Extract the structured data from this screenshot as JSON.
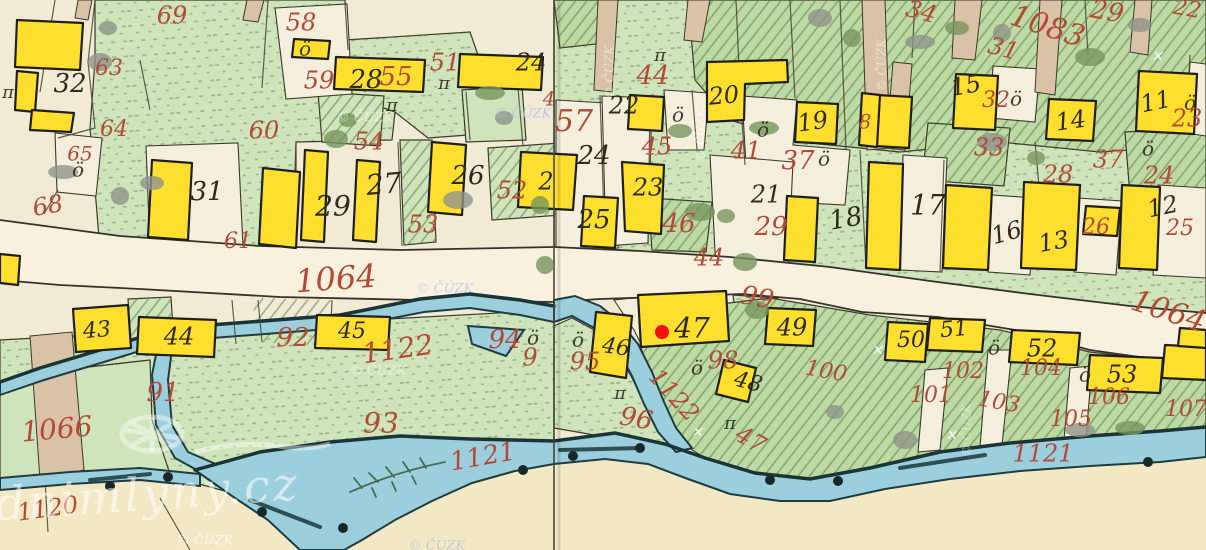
{
  "map": {
    "description": "historical hand-drawn cadastral map sheet join with stream, road and building parcels",
    "colors": {
      "paper": "#f1ebd6",
      "field_green": "#cfe4bb",
      "orchard_green": "#bdd9a4",
      "building_yellow": "#ffdf2e",
      "water_blue": "#9ccfdd",
      "road_tan": "#d9c2a6",
      "ink_black": "#2e2b1e",
      "ink_red": "#b24a36",
      "marker_red": "#f01010"
    },
    "marker": {
      "x": 662,
      "y": 332,
      "radius": 7,
      "color": "#f01010"
    },
    "labels_black": [
      [
        "32",
        70,
        85,
        26,
        0
      ],
      [
        "31",
        207,
        193,
        26,
        0
      ],
      [
        "29",
        333,
        208,
        28,
        0
      ],
      [
        "28",
        366,
        81,
        26,
        0
      ],
      [
        "27",
        384,
        186,
        28,
        -5
      ],
      [
        "26",
        468,
        177,
        26,
        0
      ],
      [
        "24",
        531,
        64,
        24,
        0
      ],
      [
        "2",
        546,
        183,
        24,
        0
      ],
      [
        "24",
        594,
        157,
        26,
        0
      ],
      [
        "25",
        594,
        221,
        26,
        0
      ],
      [
        "22",
        624,
        107,
        24,
        0
      ],
      [
        "23",
        648,
        189,
        24,
        0
      ],
      [
        "20",
        724,
        97,
        24,
        -5
      ],
      [
        "21",
        766,
        196,
        24,
        0
      ],
      [
        "19",
        813,
        123,
        24,
        -8
      ],
      [
        "18",
        846,
        220,
        26,
        -10
      ],
      [
        "17",
        928,
        207,
        28,
        0
      ],
      [
        "16",
        1007,
        234,
        24,
        -15
      ],
      [
        "15",
        966,
        87,
        24,
        -10
      ],
      [
        "14",
        1071,
        122,
        24,
        -8
      ],
      [
        "13",
        1054,
        243,
        24,
        -10
      ],
      [
        "12",
        1163,
        208,
        24,
        -12
      ],
      [
        "11",
        1156,
        103,
        24,
        -12
      ],
      [
        "43",
        97,
        331,
        22,
        -5
      ],
      [
        "44",
        179,
        338,
        24,
        0
      ],
      [
        "45",
        352,
        332,
        22,
        0
      ],
      [
        "46",
        616,
        348,
        22,
        8
      ],
      [
        "47",
        692,
        330,
        28,
        0
      ],
      [
        "48",
        748,
        383,
        22,
        15
      ],
      [
        "49",
        792,
        329,
        24,
        0
      ],
      [
        "50",
        911,
        341,
        22,
        0
      ],
      [
        "51",
        954,
        330,
        22,
        -5
      ],
      [
        "52",
        1042,
        350,
        24,
        0
      ],
      [
        "53",
        1122,
        376,
        24,
        0
      ]
    ],
    "labels_red": [
      [
        "69",
        172,
        17,
        24,
        0
      ],
      [
        "58",
        301,
        24,
        24,
        0
      ],
      [
        "59",
        319,
        82,
        24,
        0
      ],
      [
        "63",
        109,
        69,
        22,
        0
      ],
      [
        "64",
        114,
        130,
        22,
        0
      ],
      [
        "65",
        80,
        155,
        20,
        0
      ],
      [
        "68",
        48,
        207,
        24,
        -10
      ],
      [
        "60",
        264,
        132,
        24,
        0
      ],
      [
        "61",
        238,
        242,
        22,
        0
      ],
      [
        "55",
        396,
        78,
        26,
        0
      ],
      [
        "51",
        445,
        64,
        24,
        0
      ],
      [
        "54",
        369,
        143,
        24,
        0
      ],
      [
        "53",
        423,
        226,
        24,
        0
      ],
      [
        "52",
        512,
        192,
        24,
        0
      ],
      [
        "4",
        549,
        100,
        20,
        0
      ],
      [
        "57",
        574,
        123,
        30,
        0
      ],
      [
        "44",
        653,
        77,
        26,
        0
      ],
      [
        "45",
        657,
        148,
        24,
        0
      ],
      [
        "41",
        746,
        152,
        24,
        0
      ],
      [
        "37",
        798,
        162,
        26,
        0
      ],
      [
        "46",
        679,
        225,
        26,
        0
      ],
      [
        "29",
        771,
        228,
        26,
        0
      ],
      [
        "44",
        709,
        259,
        24,
        0
      ],
      [
        "34",
        921,
        13,
        24,
        15
      ],
      [
        "1083",
        1047,
        28,
        30,
        18
      ],
      [
        "29",
        1107,
        13,
        26,
        10
      ],
      [
        "22",
        1187,
        10,
        22,
        10
      ],
      [
        "31",
        1003,
        50,
        24,
        15
      ],
      [
        "32",
        996,
        101,
        22,
        0
      ],
      [
        "23",
        1187,
        120,
        24,
        0
      ],
      [
        "33",
        989,
        149,
        24,
        0
      ],
      [
        "37",
        1108,
        161,
        24,
        0
      ],
      [
        "28",
        1058,
        176,
        24,
        0
      ],
      [
        "24",
        1159,
        177,
        24,
        0
      ],
      [
        "26",
        1096,
        228,
        22,
        0
      ],
      [
        "25",
        1180,
        229,
        22,
        0
      ],
      [
        "8",
        865,
        123,
        20,
        0
      ],
      [
        "92",
        293,
        339,
        26,
        0
      ],
      [
        "91",
        163,
        394,
        26,
        0
      ],
      [
        "93",
        381,
        425,
        28,
        0
      ],
      [
        "1066",
        57,
        431,
        28,
        -5
      ],
      [
        "1064",
        336,
        281,
        32,
        -4
      ],
      [
        "1064",
        1168,
        313,
        30,
        18
      ],
      [
        "1122",
        398,
        351,
        28,
        -8
      ],
      [
        "1122",
        673,
        396,
        24,
        48
      ],
      [
        "94",
        505,
        341,
        26,
        0
      ],
      [
        "9",
        530,
        359,
        24,
        0
      ],
      [
        "95",
        585,
        363,
        24,
        0
      ],
      [
        "96",
        636,
        420,
        26,
        10
      ],
      [
        "98",
        723,
        362,
        24,
        0
      ],
      [
        "99",
        757,
        299,
        26,
        10
      ],
      [
        "47",
        750,
        441,
        24,
        30
      ],
      [
        "100",
        826,
        372,
        22,
        10
      ],
      [
        "101",
        931,
        396,
        22,
        0
      ],
      [
        "102",
        963,
        372,
        22,
        0
      ],
      [
        "103",
        999,
        403,
        22,
        10
      ],
      [
        "104",
        1041,
        369,
        22,
        0
      ],
      [
        "105",
        1071,
        420,
        22,
        0
      ],
      [
        "106",
        1109,
        398,
        22,
        0
      ],
      [
        "107",
        1186,
        410,
        22,
        0
      ],
      [
        "1121",
        483,
        458,
        26,
        -10
      ],
      [
        "1121",
        1043,
        455,
        24,
        0
      ],
      [
        "1120",
        48,
        510,
        24,
        -8
      ]
    ],
    "symbols": {
      "tree_o": [
        [
          305,
          50
        ],
        [
          78,
          171
        ],
        [
          678,
          116
        ],
        [
          763,
          131
        ],
        [
          824,
          160
        ],
        [
          1016,
          100
        ],
        [
          533,
          339
        ],
        [
          578,
          341
        ],
        [
          697,
          369
        ],
        [
          994,
          349
        ],
        [
          1085,
          376
        ],
        [
          1190,
          104
        ],
        [
          1148,
          150
        ]
      ],
      "grass_pi": [
        [
          8,
          93
        ],
        [
          392,
          106
        ],
        [
          444,
          84
        ],
        [
          660,
          56
        ],
        [
          620,
          394
        ],
        [
          730,
          424
        ]
      ],
      "survey_cross": [
        [
          697,
          433
        ],
        [
          877,
          351
        ],
        [
          951,
          436
        ],
        [
          1157,
          57
        ]
      ],
      "river_dots": [
        [
          110,
          486
        ],
        [
          168,
          477
        ],
        [
          262,
          512
        ],
        [
          343,
          528
        ],
        [
          523,
          470
        ],
        [
          573,
          456
        ],
        [
          770,
          480
        ],
        [
          838,
          481
        ],
        [
          1148,
          462
        ],
        [
          640,
          448
        ]
      ],
      "trees_gray": [
        [
          108,
          28
        ],
        [
          100,
          62
        ],
        [
          63,
          172
        ],
        [
          120,
          196
        ],
        [
          152,
          183
        ],
        [
          458,
          200
        ],
        [
          504,
          118
        ],
        [
          820,
          18
        ],
        [
          920,
          42
        ],
        [
          1002,
          33
        ],
        [
          1140,
          25
        ],
        [
          992,
          142
        ],
        [
          835,
          412
        ],
        [
          905,
          440
        ],
        [
          1080,
          430
        ]
      ],
      "bushes_green": [
        [
          348,
          120
        ],
        [
          336,
          139
        ],
        [
          490,
          93
        ],
        [
          540,
          205
        ],
        [
          680,
          131
        ],
        [
          700,
          212
        ],
        [
          726,
          216
        ],
        [
          745,
          262
        ],
        [
          764,
          128
        ],
        [
          852,
          38
        ],
        [
          957,
          28
        ],
        [
          1090,
          57
        ],
        [
          1036,
          158
        ],
        [
          757,
          310
        ],
        [
          1130,
          428
        ],
        [
          545,
          265
        ]
      ]
    },
    "watermarks": [
      {
        "text": "© ČÚZK",
        "x": 365,
        "y": 118,
        "rot": 0,
        "color": "#ffffff",
        "opacity": 0.55,
        "size": 13
      },
      {
        "text": "© ČÚZK",
        "x": 523,
        "y": 114,
        "rot": 0,
        "color": "#aebfe4",
        "opacity": 0.8,
        "size": 13
      },
      {
        "text": "© ČÚZK",
        "x": 445,
        "y": 289,
        "rot": 0,
        "color": "#b9c7ea",
        "opacity": 0.8,
        "size": 13
      },
      {
        "text": "© ČÚZK",
        "x": 378,
        "y": 371,
        "rot": 0,
        "color": "#ffffff",
        "opacity": 0.5,
        "size": 13
      },
      {
        "text": "© ČÚZK",
        "x": 205,
        "y": 541,
        "rot": 0,
        "color": "#ffffff",
        "opacity": 0.6,
        "size": 13
      },
      {
        "text": "© ČÚZK",
        "x": 437,
        "y": 546,
        "rot": 0,
        "color": "#aebfe4",
        "opacity": 0.7,
        "size": 13
      },
      {
        "text": "© ČÚZK",
        "x": 610,
        "y": 72,
        "rot": -90,
        "color": "#ffffff",
        "opacity": 0.5,
        "size": 12
      },
      {
        "text": "© ČÚZK",
        "x": 701,
        "y": 135,
        "rot": -90,
        "color": "#ffffff",
        "opacity": 0.5,
        "size": 12
      },
      {
        "text": "© ČÚZK",
        "x": 882,
        "y": 65,
        "rot": -90,
        "color": "#ffffff",
        "opacity": 0.5,
        "size": 12
      },
      {
        "text": "© ČÚZK",
        "x": 967,
        "y": 430,
        "rot": -90,
        "color": "#ffffff",
        "opacity": 0.45,
        "size": 12
      },
      {
        "text": "vodnimlyny.cz",
        "x": 118,
        "y": 500,
        "rot": -4,
        "color": "#ffffff",
        "opacity": 0.55,
        "size": 46
      }
    ]
  }
}
